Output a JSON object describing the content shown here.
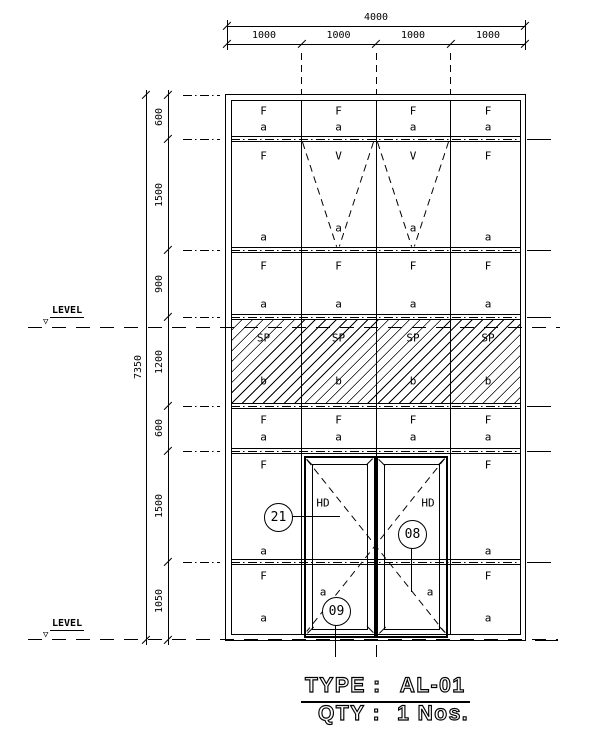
{
  "colors": {
    "line": "#000000",
    "background": "#ffffff"
  },
  "dims": {
    "top_overall": "4000",
    "top_segments": [
      "1000",
      "1000",
      "1000",
      "1000"
    ],
    "left_overall": "7350",
    "left_segments": [
      "600",
      "1500",
      "900",
      "1200",
      "600",
      "1500",
      "1050"
    ]
  },
  "level_label": "LEVEL",
  "rows": [
    {
      "cells": [
        {
          "t": "F",
          "b": "a"
        },
        {
          "t": "F",
          "b": "a"
        },
        {
          "t": "F",
          "b": "a"
        },
        {
          "t": "F",
          "b": "a"
        }
      ]
    },
    {
      "cells": [
        {
          "t": "F",
          "b": "a"
        },
        {
          "t": "V",
          "b": "a"
        },
        {
          "t": "V",
          "b": "a"
        },
        {
          "t": "F",
          "b": "a"
        }
      ]
    },
    {
      "cells": [
        {
          "t": "F",
          "b": "a"
        },
        {
          "t": "F",
          "b": "a"
        },
        {
          "t": "F",
          "b": "a"
        },
        {
          "t": "F",
          "b": "a"
        }
      ]
    },
    {
      "cells": [
        {
          "t": "SP",
          "b": "b"
        },
        {
          "t": "SP",
          "b": "b"
        },
        {
          "t": "SP",
          "b": "b"
        },
        {
          "t": "SP",
          "b": "b"
        }
      ]
    },
    {
      "cells": [
        {
          "t": "F",
          "b": "a"
        },
        {
          "t": "F",
          "b": "a"
        },
        {
          "t": "F",
          "b": "a"
        },
        {
          "t": "F",
          "b": "a"
        }
      ]
    },
    {
      "cells": [
        {
          "t": "F",
          "b": "a"
        },
        {
          "t": "HD"
        },
        {
          "t": "HD"
        },
        {
          "t": "F",
          "b": "a"
        }
      ]
    },
    {
      "cells": [
        {
          "t": "F",
          "b": "a"
        },
        {
          "b": "a"
        },
        {
          "b": "a"
        },
        {
          "t": "F",
          "b": "a"
        }
      ]
    }
  ],
  "callouts": [
    "21",
    "08",
    "09"
  ],
  "title": {
    "type_label": "TYPE :",
    "type_value": "AL-01",
    "qty_label": "QTY :",
    "qty_value": "1 Nos."
  }
}
